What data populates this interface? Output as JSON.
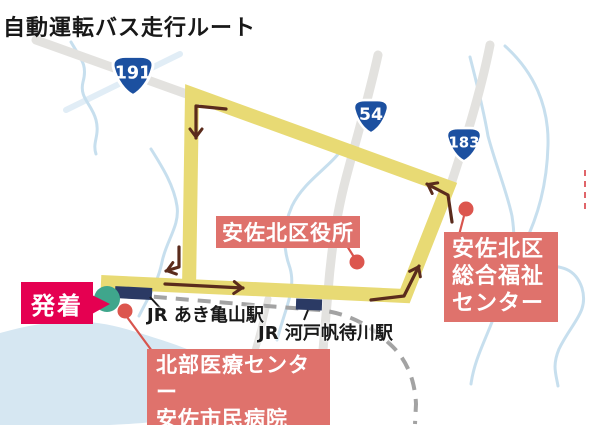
{
  "title": "自動運転バス走行ルート",
  "map": {
    "route_shields": [
      {
        "icon": "route-shield-icon",
        "number": "191"
      },
      {
        "icon": "route-shield-icon",
        "number": "54"
      },
      {
        "icon": "route-shield-icon",
        "number": "183"
      }
    ],
    "stations": [
      {
        "name": "JR あき亀山駅"
      },
      {
        "name": "JR 河戸帆待川駅"
      }
    ],
    "callouts": {
      "depart": "発着",
      "ward_office": "安佐北区役所",
      "welfare_center": [
        "安佐北区",
        "総合福祉",
        "センター"
      ],
      "hospital": [
        "北部医療センター",
        "安佐市民病院"
      ]
    },
    "colors": {
      "route_yellow": "#e8da74",
      "depart_pink": "#e50051",
      "callout_salmon": "#df726c",
      "station_navy": "#2b3a64",
      "terminal_teal": "#3fa68c",
      "arrow_brown": "#5a2b1c",
      "shield_blue": "#1c50a0",
      "road_gray": "#e3e2df",
      "rail_gray": "#a3a3a3",
      "river_blue": "#cfe3f0"
    }
  }
}
